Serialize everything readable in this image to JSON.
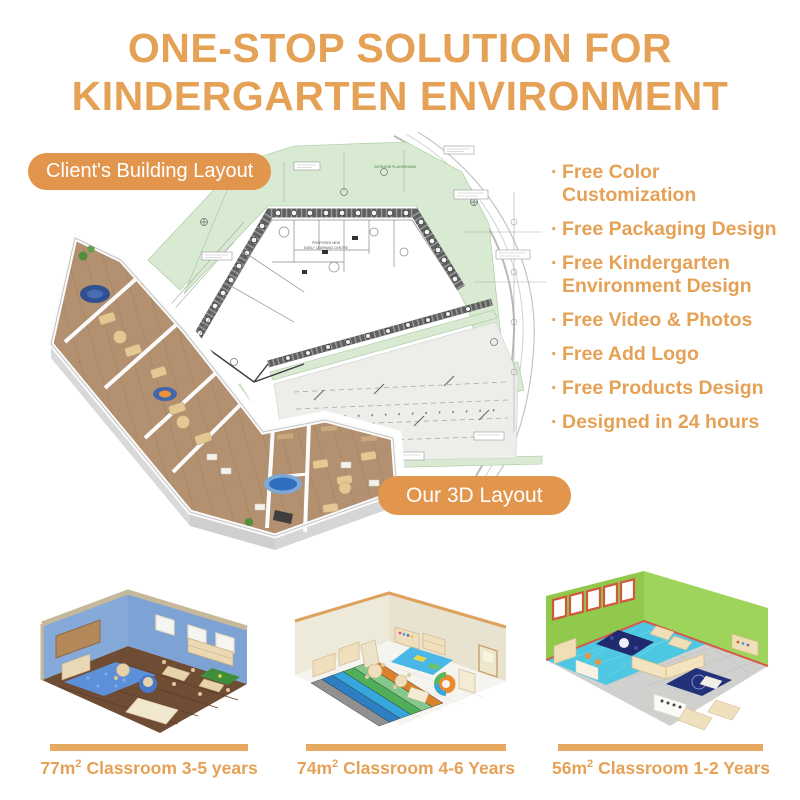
{
  "header": {
    "title_line1": "ONE-STOP SOLUTION FOR",
    "title_line2": "KINDERGARTEN ENVIRONMENT"
  },
  "badges": {
    "client_layout": "Client's Building Layout",
    "our_3d_layout": "Our 3D Layout"
  },
  "features": {
    "bullet": "·",
    "items": [
      "Free Color Customization",
      "Free Packaging Design",
      "Free Kindergarten Environment Design",
      "Free Video & Photos",
      "Free Add Logo",
      "Free Products Design",
      "Designed in 24 hours"
    ]
  },
  "plan": {
    "note": "OUTDOOR PLAYGROUND",
    "building_label_1": "PROPOSED NEW",
    "building_label_2": "EARLY LEARNING CENTRE"
  },
  "classrooms": [
    {
      "area": "77m",
      "area_exp": "2",
      "label": "Classroom 3-5 years"
    },
    {
      "area": "74m",
      "area_exp": "2",
      "label": "Classroom 4-6 Years"
    },
    {
      "area": "56m",
      "area_exp": "2",
      "label": "Classroom 1-2 Years"
    }
  ],
  "palette": {
    "accent_text": "#E5A155",
    "pill_bg": "#E2954C",
    "divider_bar": "#E7A85F",
    "plan_green": "#D9EAD2",
    "plan_wall": "#606060",
    "parking_gray": "#EDEDE9",
    "wood_floor": "#B29070",
    "pool_blue": "#2F6FBE",
    "room1_wall_blue": "#85AADA",
    "room1_floor_brown": "#6F4C34",
    "room2_wall_cream": "#EDEADA",
    "room3_wall_green": "#93CB4E",
    "room3_floor_cyan": "#4EC8E2",
    "window_frame_orange": "#D2573C"
  }
}
